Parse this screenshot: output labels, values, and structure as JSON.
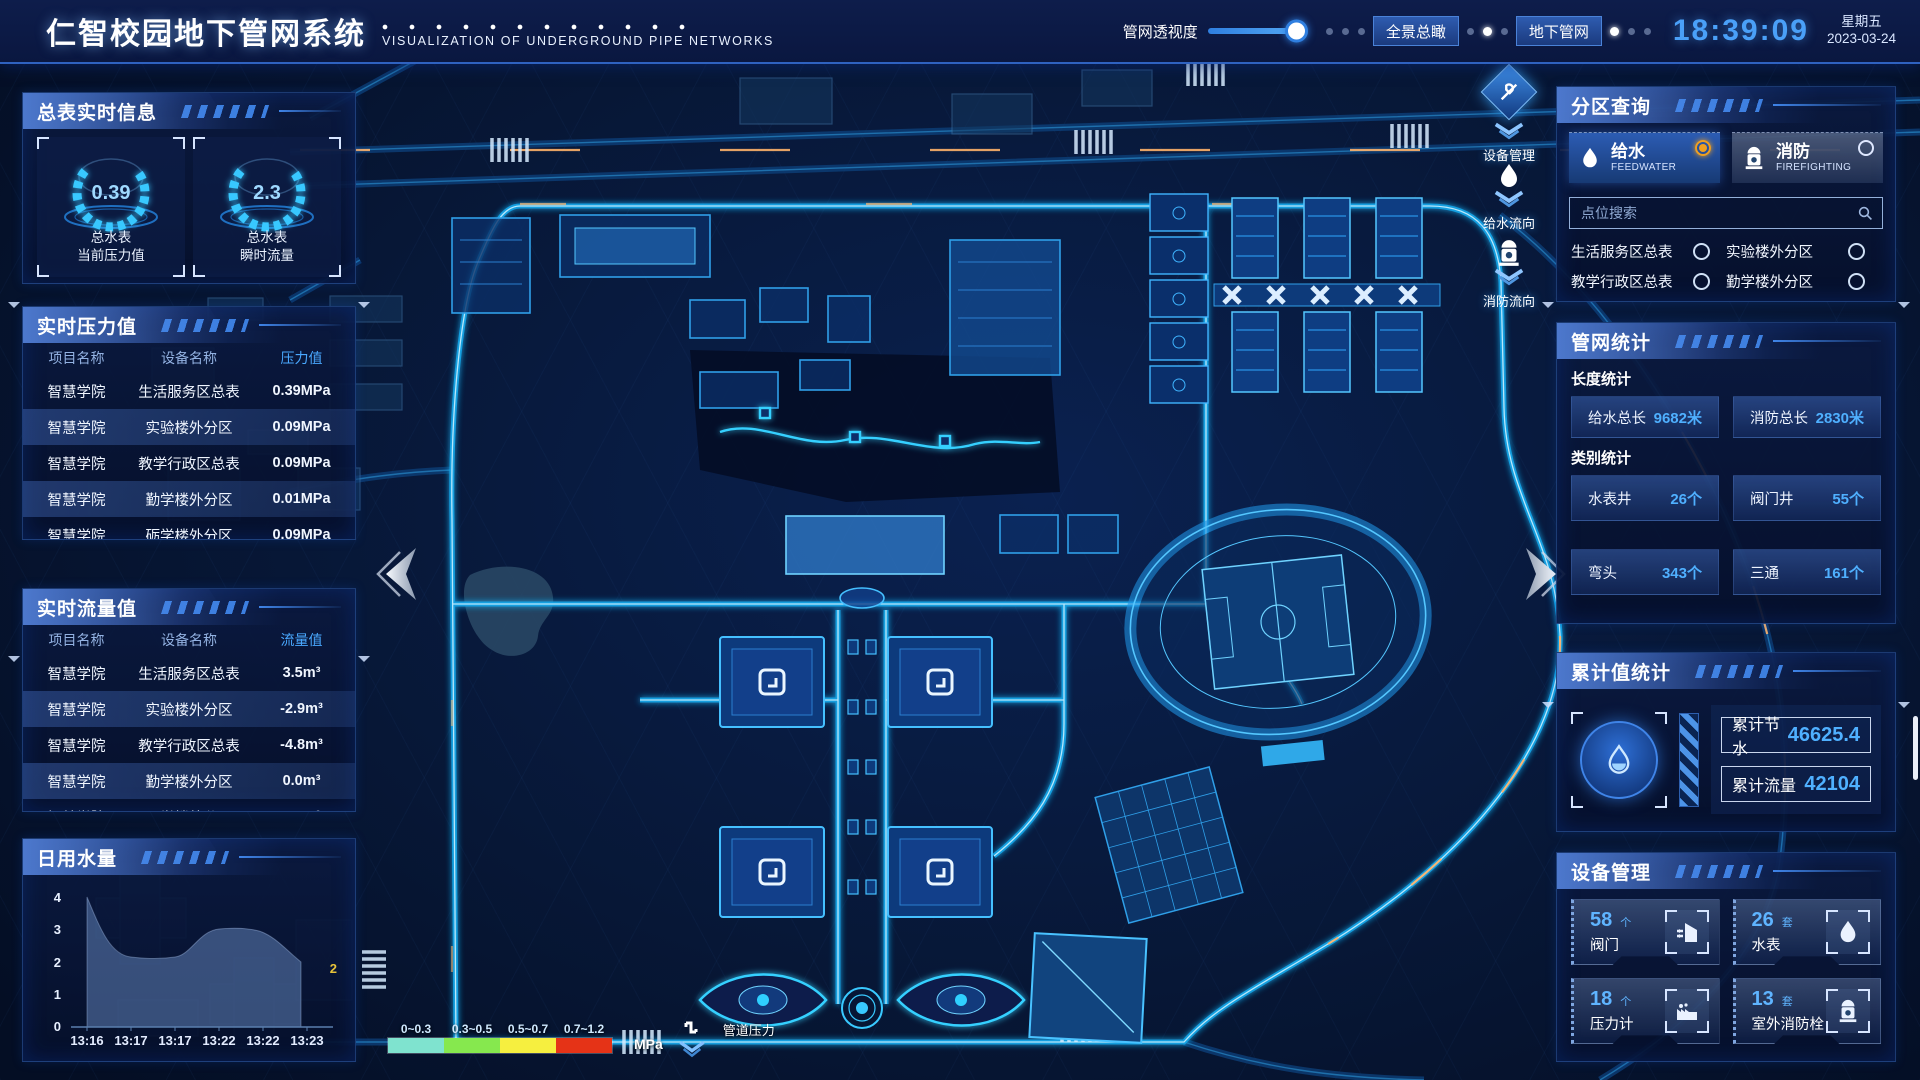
{
  "header": {
    "title": "仁智校园地下管网系统",
    "subtitle": "VISUALIZATION OF UNDERGROUND PIPE NETWORKS",
    "opacity_label": "管网透视度",
    "btn_overview": "全景总瞰",
    "btn_underground": "地下管网",
    "time": "18:39:09",
    "weekday": "星期五",
    "date": "2023-03-24"
  },
  "left": {
    "meter_panel": {
      "title": "总表实时信息",
      "gauges": [
        {
          "value": "0.39",
          "line1": "总水表",
          "line2": "当前压力值"
        },
        {
          "value": "2.3",
          "line1": "总水表",
          "line2": "瞬时流量"
        }
      ]
    },
    "pressure_panel": {
      "title": "实时压力值",
      "headers": [
        "项目名称",
        "设备名称",
        "压力值"
      ],
      "rows": [
        [
          "智慧学院",
          "生活服务区总表",
          "0.39MPa"
        ],
        [
          "智慧学院",
          "实验楼外分区",
          "0.09MPa"
        ],
        [
          "智慧学院",
          "教学行政区总表",
          "0.09MPa"
        ],
        [
          "智慧学院",
          "勤学楼外分区",
          "0.01MPa"
        ],
        [
          "智慧学院",
          "砺学楼外分区",
          "0.09MPa"
        ]
      ]
    },
    "flow_panel": {
      "title": "实时流量值",
      "headers": [
        "项目名称",
        "设备名称",
        "流量值"
      ],
      "rows": [
        [
          "智慧学院",
          "生活服务区总表",
          "3.5m³"
        ],
        [
          "智慧学院",
          "实验楼外分区",
          "-2.9m³"
        ],
        [
          "智慧学院",
          "教学行政区总表",
          "-4.8m³"
        ],
        [
          "智慧学院",
          "勤学楼外分区",
          "0.0m³"
        ],
        [
          "智慧学院",
          "砺学楼外分区",
          "2.3m³"
        ]
      ]
    },
    "daily_panel": {
      "title": "日用水量"
    }
  },
  "chart_data": {
    "type": "area",
    "title": "日用水量",
    "x": [
      "13:16",
      "13:17",
      "13:17",
      "13:22",
      "13:22",
      "13:23"
    ],
    "values": [
      4,
      2.2,
      2.2,
      3,
      3,
      2
    ],
    "ylim": [
      0,
      4
    ],
    "yticks": [
      "4",
      "3",
      "2",
      "1",
      "0"
    ],
    "end_label": "2",
    "legend_position": "none",
    "grid": false
  },
  "map": {
    "overlay_buttons": [
      {
        "label": "设备管理"
      },
      {
        "label": "给水流向"
      },
      {
        "label": "消防流向"
      }
    ],
    "legend": {
      "ranges": [
        "0~0.3",
        "0.3~0.5",
        "0.5~0.7",
        "0.7~1.2"
      ],
      "colors": [
        "#7fe3cf",
        "#86e84e",
        "#f6ef3f",
        "#e53317"
      ],
      "unit": "MPa",
      "label": "管道压力"
    }
  },
  "right": {
    "zone_panel": {
      "title": "分区查询",
      "feed_tab": {
        "label": "给水",
        "sub": "FEEDWATER"
      },
      "fire_tab": {
        "label": "消防",
        "sub": "FIREFIGHTING"
      },
      "search_placeholder": "点位搜索",
      "options": [
        "生活服务区总表",
        "实验楼外分区",
        "教学行政区总表",
        "勤学楼外分区",
        "砺学楼外分区",
        "宿舍区泵房"
      ]
    },
    "stats_panel": {
      "title": "管网统计",
      "length_title": "长度统计",
      "length_stats": [
        {
          "label": "给水总长",
          "value": "9682米"
        },
        {
          "label": "消防总长",
          "value": "2830米"
        }
      ],
      "category_title": "类别统计",
      "category_stats": [
        {
          "label": "水表井",
          "value": "26个"
        },
        {
          "label": "阀门井",
          "value": "55个"
        },
        {
          "label": "弯头",
          "value": "343个"
        },
        {
          "label": "三通",
          "value": "161个"
        }
      ]
    },
    "total_panel": {
      "title": "累计值统计",
      "items": [
        {
          "label": "累计节水",
          "value": "46625.4"
        },
        {
          "label": "累计流量",
          "value": "42104"
        }
      ]
    },
    "device_panel": {
      "title": "设备管理",
      "cards": [
        {
          "count": "58",
          "unit": "个",
          "label": "阀门"
        },
        {
          "count": "26",
          "unit": "套",
          "label": "水表"
        },
        {
          "count": "18",
          "unit": "个",
          "label": "压力计"
        },
        {
          "count": "13",
          "unit": "套",
          "label": "室外消防栓"
        }
      ]
    }
  }
}
